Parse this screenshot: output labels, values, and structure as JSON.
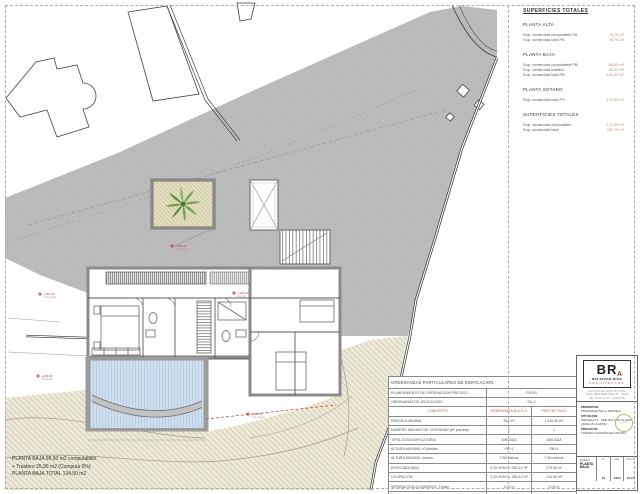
{
  "surfaces": {
    "title": "SUPERFICIES TOTALES",
    "sections": [
      {
        "heading": "PLANTA ALTA",
        "rows": [
          [
            "Sup. construida computable PA",
            "76,76 m²"
          ],
          [
            "Sup. construida total PA",
            "76,76 m²"
          ]
        ]
      },
      {
        "heading": "PLANTA BAJA",
        "rows": [
          [
            "Sup. construida computable PB",
            "98,60 m²"
          ],
          [
            "Sup. construida trastero",
            "35,90 m²"
          ],
          [
            "Sup. construida total PB",
            "134,50 m²"
          ]
        ]
      },
      {
        "heading": "PLANTA SÓTANO",
        "rows": [
          [
            "Sup. construida total PS",
            "121,50 m²"
          ]
        ]
      },
      {
        "heading": "SUPERFICIES TOTALES",
        "rows": [
          [
            "Sup. construida computable",
            "175,36 m²"
          ],
          [
            "Sup. construida total",
            "332,76 m²"
          ]
        ]
      }
    ]
  },
  "note": {
    "lines": [
      "PLANTA BAJA 98,60 m2 computables",
      "+ Trastero 35,90 m2 (Computa 0%)",
      "PLANTA BAJA TOTAL  134,50 m2"
    ]
  },
  "ordinances": {
    "title": "ORDENANZAS PARTICULARES DE EDIFICACION",
    "info": [
      [
        "PLANEAMIENTO DE ORDENACION PRECISO",
        "PGOU"
      ],
      [
        "ORDENANZA DE APLICACION",
        "SU-2"
      ]
    ],
    "header": [
      "CONCEPTO",
      "ORDENANZA N.N.S.S.",
      "PROYECTADO"
    ],
    "rows": [
      [
        "PARCELA MINIMA",
        "500 m²",
        "1.132,50 m²"
      ],
      [
        "NUMERO MAXIMO DE VIVIENDAS (Nº parcela)",
        "1",
        "1"
      ],
      [
        "TIPOLOGIA EDIFICATORIA",
        "AISLADA",
        "AISLADA"
      ],
      [
        "ALTURA MAXIMA, nº plantas",
        "PB+1",
        "PB+1"
      ],
      [
        "ALTURA MAXIMA, metros",
        "7,50 metros",
        "7,50 metros"
      ],
      [
        "EDIFICABILIDAD",
        "0,25 m²/m² = 283,12 m²",
        "175,36 m²"
      ],
      [
        "OCUPACION",
        "0,25 m²/m² = 283,12 m²",
        "134,50 m²"
      ],
      [
        "SEPARACION A LINDEROS, Fondo",
        "3,00 m",
        "3,00 m"
      ],
      [
        "SEPARACION A VIALES (Frente), fondo",
        "3,00 m",
        "3,00 m"
      ]
    ]
  },
  "titleblock": {
    "logo": {
      "initials": "BR",
      "accent": "A",
      "name": "BALTASAR RÍOS",
      "profession": "ARQUITECTOS",
      "contact1": "ESTUDIO DE ARQUITECTURA",
      "contact2": "AVDA. MEDITERRANEO 28 · JAVEA",
      "contact3": "TEL 96 573 21 10 · ALICANTE"
    },
    "promoter_label": "PROMOTOR:",
    "promoter": "PROPIEDAD DE LA PARCELA",
    "location_label": "SITUACION:",
    "location1": "PARCELA 74 · URB. BALCON AL MAR",
    "location2": "JAVEA (ALICANTE)",
    "project_label": "PROYECTO:",
    "project": "VIVIENDA UNIFAMILIAR AISLADA",
    "stamp": "VISADO",
    "plan_label": "PLANO:",
    "plan_name": "PLANTA BAJA",
    "number_label": "Nº",
    "number": "03",
    "scale_label": "ESC.",
    "scale": "1/100",
    "date_label": "FECHA",
    "date": "04.16"
  },
  "markers": [
    {
      "l1": "+164,25",
      "l2": "cota porche"
    },
    {
      "l1": "+163,90",
      "l2": "cota jardin"
    },
    {
      "l1": "+165,30",
      "l2": "cota patio"
    },
    {
      "l1": "+165,00",
      "l2": "cota pb"
    },
    {
      "l1": "+162,50",
      "l2": "cota piscina"
    }
  ],
  "colors": {
    "accent_red": "#c0392b",
    "value_red": "#c98f88",
    "hatch_gray": "#b3b3b3",
    "terrain_tan": "#edeadb",
    "pool_blue": "#cfdfee",
    "palm_green": "#73a04f"
  }
}
